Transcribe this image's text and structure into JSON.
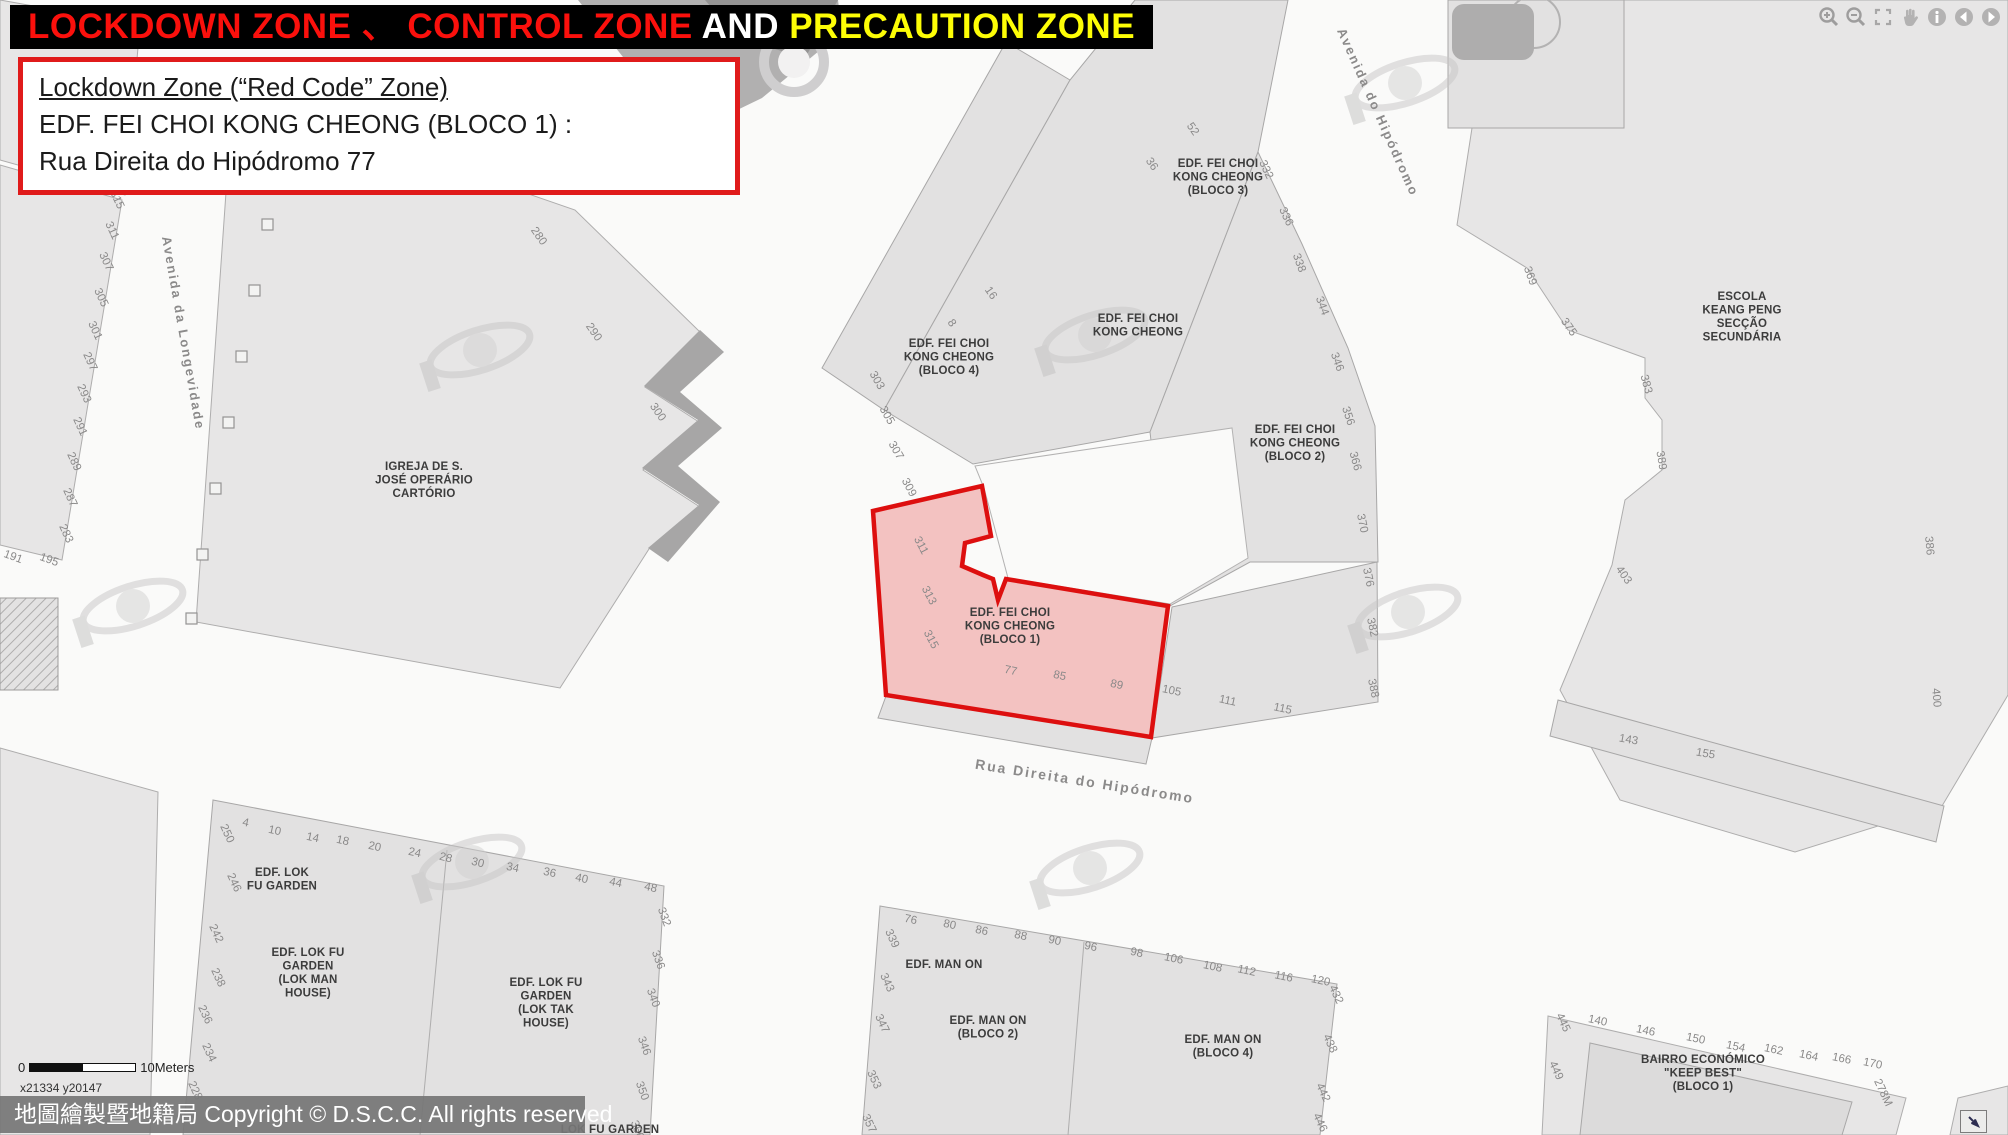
{
  "title": {
    "part1": "LOCKDOWN ZONE 、 CONTROL ZONE",
    "part2": " AND ",
    "part3": "PRECAUTION ZONE"
  },
  "info_box": {
    "line1": "Lockdown Zone (“Red Code” Zone)",
    "line2": "EDF. FEI CHOI KONG CHEONG (BLOCO 1) :",
    "line3": "Rua Direita do Hipódromo  77"
  },
  "toolbar": {
    "buttons": [
      "zoom-in",
      "zoom-out",
      "full-extent",
      "pan",
      "identify",
      "previous-extent",
      "next-extent"
    ]
  },
  "scale_bar": {
    "zero_label": "0",
    "distance_label": "10Meters",
    "coordinates": "x21334  y20147"
  },
  "copyright_bar": {
    "text": "地圖繪製暨地籍局 Copyright © D.S.C.C. All rights reserved"
  },
  "colors": {
    "title_red": "#fb100c",
    "title_white": "#ffffff",
    "title_yellow": "#fdfd06",
    "info_border": "#e01b1b",
    "lockdown_fill": "#f1b7b7",
    "lockdown_border": "#dd0f0f"
  },
  "map": {
    "street_labels": [
      {
        "text": "Avenida da Longevidade",
        "x": 179,
        "y": 334,
        "rot": 80,
        "size": 13
      },
      {
        "text": "Avenida do Hipódromo",
        "x": 1374,
        "y": 114,
        "rot": 66,
        "size": 13
      },
      {
        "text": "Rua Direita do Hipódromo",
        "x": 1084,
        "y": 786,
        "rot": 9,
        "size": 14
      }
    ],
    "building_labels": [
      {
        "lines": [
          "IGREJA DE S.",
          "JOSÉ OPERÁRIO",
          "CARTÓRIO"
        ],
        "x": 424,
        "y": 470
      },
      {
        "lines": [
          "EDF. FEI CHOI",
          "KONG CHEONG",
          "(BLOCO 4)"
        ],
        "x": 949,
        "y": 347
      },
      {
        "lines": [
          "EDF. FEI CHOI",
          "KONG CHEONG",
          "(BLOCO 3)"
        ],
        "x": 1218,
        "y": 167
      },
      {
        "lines": [
          "EDF. FEI CHOI",
          "KONG CHEONG"
        ],
        "x": 1138,
        "y": 322
      },
      {
        "lines": [
          "EDF. FEI CHOI",
          "KONG CHEONG",
          "(BLOCO 2)"
        ],
        "x": 1295,
        "y": 433
      },
      {
        "lines": [
          "EDF. FEI CHOI",
          "KONG CHEONG",
          "(BLOCO 1)"
        ],
        "x": 1010,
        "y": 616
      },
      {
        "lines": [
          "ESCOLA",
          "KEANG PENG",
          "SECÇÃO",
          "SECUNDÁRIA"
        ],
        "x": 1742,
        "y": 300
      },
      {
        "lines": [
          "EDF. LOK",
          "FU GARDEN"
        ],
        "x": 282,
        "y": 876
      },
      {
        "lines": [
          "EDF. LOK FU",
          "GARDEN",
          "(LOK MAN",
          "HOUSE)"
        ],
        "x": 308,
        "y": 956
      },
      {
        "lines": [
          "EDF. LOK FU",
          "GARDEN",
          "(LOK TAK",
          "HOUSE)"
        ],
        "x": 546,
        "y": 986
      },
      {
        "lines": [
          "EDF. MAN ON"
        ],
        "x": 944,
        "y": 968
      },
      {
        "lines": [
          "EDF. MAN ON",
          "(BLOCO 2)"
        ],
        "x": 988,
        "y": 1024
      },
      {
        "lines": [
          "EDF. MAN ON",
          "(BLOCO 4)"
        ],
        "x": 1223,
        "y": 1043
      },
      {
        "lines": [
          "BAIRRO ECONÓMICO",
          "\"KEEP BEST\"",
          "(BLOCO 1)"
        ],
        "x": 1703,
        "y": 1063
      },
      {
        "lines": [
          "LOK FU GARDEN"
        ],
        "x": 610,
        "y": 1133
      }
    ],
    "house_numbers": [
      {
        "t": "315",
        "x": 114,
        "y": 201,
        "r": 65
      },
      {
        "t": "311",
        "x": 109,
        "y": 232,
        "r": 65
      },
      {
        "t": "307",
        "x": 103,
        "y": 263,
        "r": 65
      },
      {
        "t": "305",
        "x": 98,
        "y": 299,
        "r": 65
      },
      {
        "t": "301",
        "x": 92,
        "y": 332,
        "r": 65
      },
      {
        "t": "297",
        "x": 87,
        "y": 363,
        "r": 65
      },
      {
        "t": "293",
        "x": 81,
        "y": 395,
        "r": 65
      },
      {
        "t": "291",
        "x": 77,
        "y": 428,
        "r": 65
      },
      {
        "t": "289",
        "x": 71,
        "y": 463,
        "r": 65
      },
      {
        "t": "287",
        "x": 67,
        "y": 499,
        "r": 65
      },
      {
        "t": "283",
        "x": 63,
        "y": 535,
        "r": 65
      },
      {
        "t": "191",
        "x": 12,
        "y": 560,
        "r": 20
      },
      {
        "t": "195",
        "x": 48,
        "y": 563,
        "r": 20
      },
      {
        "t": "280",
        "x": 536,
        "y": 238,
        "r": 55
      },
      {
        "t": "290",
        "x": 591,
        "y": 334,
        "r": 55
      },
      {
        "t": "300",
        "x": 655,
        "y": 414,
        "r": 55
      },
      {
        "t": "8",
        "x": 949,
        "y": 325,
        "r": 55
      },
      {
        "t": "16",
        "x": 988,
        "y": 295,
        "r": 55
      },
      {
        "t": "36",
        "x": 1149,
        "y": 166,
        "r": 55
      },
      {
        "t": "52",
        "x": 1190,
        "y": 131,
        "r": 55
      },
      {
        "t": "332",
        "x": 1263,
        "y": 171,
        "r": 65
      },
      {
        "t": "336",
        "x": 1283,
        "y": 218,
        "r": 65
      },
      {
        "t": "338",
        "x": 1296,
        "y": 264,
        "r": 70
      },
      {
        "t": "344",
        "x": 1319,
        "y": 307,
        "r": 70
      },
      {
        "t": "346",
        "x": 1334,
        "y": 363,
        "r": 70
      },
      {
        "t": "356",
        "x": 1345,
        "y": 417,
        "r": 72
      },
      {
        "t": "366",
        "x": 1352,
        "y": 462,
        "r": 75
      },
      {
        "t": "370",
        "x": 1359,
        "y": 524,
        "r": 78
      },
      {
        "t": "376",
        "x": 1365,
        "y": 578,
        "r": 78
      },
      {
        "t": "382",
        "x": 1369,
        "y": 628,
        "r": 78
      },
      {
        "t": "388",
        "x": 1370,
        "y": 689,
        "r": 78
      },
      {
        "t": "303",
        "x": 874,
        "y": 382,
        "r": 60
      },
      {
        "t": "305",
        "x": 884,
        "y": 417,
        "r": 60
      },
      {
        "t": "307",
        "x": 893,
        "y": 452,
        "r": 60
      },
      {
        "t": "309",
        "x": 906,
        "y": 489,
        "r": 62
      },
      {
        "t": "311",
        "x": 918,
        "y": 547,
        "r": 62
      },
      {
        "t": "313",
        "x": 926,
        "y": 597,
        "r": 62
      },
      {
        "t": "315",
        "x": 928,
        "y": 641,
        "r": 62
      },
      {
        "t": "77",
        "x": 1010,
        "y": 674,
        "r": 12
      },
      {
        "t": "85",
        "x": 1059,
        "y": 679,
        "r": 12
      },
      {
        "t": "89",
        "x": 1116,
        "y": 688,
        "r": 12
      },
      {
        "t": "105",
        "x": 1171,
        "y": 694,
        "r": 12
      },
      {
        "t": "111",
        "x": 1227,
        "y": 704,
        "r": 12
      },
      {
        "t": "115",
        "x": 1282,
        "y": 712,
        "r": 12
      },
      {
        "t": "369",
        "x": 1527,
        "y": 277,
        "r": 70
      },
      {
        "t": "375",
        "x": 1566,
        "y": 329,
        "r": 55
      },
      {
        "t": "383",
        "x": 1643,
        "y": 385,
        "r": 75
      },
      {
        "t": "389",
        "x": 1658,
        "y": 461,
        "r": 80
      },
      {
        "t": "403",
        "x": 1621,
        "y": 577,
        "r": 55
      },
      {
        "t": "386",
        "x": 1926,
        "y": 546,
        "r": 85
      },
      {
        "t": "400",
        "x": 1933,
        "y": 698,
        "r": 85
      },
      {
        "t": "143",
        "x": 1628,
        "y": 743,
        "r": 10
      },
      {
        "t": "155",
        "x": 1705,
        "y": 757,
        "r": 10
      },
      {
        "t": "4",
        "x": 245,
        "y": 826,
        "r": 12
      },
      {
        "t": "10",
        "x": 274,
        "y": 834,
        "r": 12
      },
      {
        "t": "14",
        "x": 312,
        "y": 841,
        "r": 12
      },
      {
        "t": "18",
        "x": 342,
        "y": 844,
        "r": 12
      },
      {
        "t": "20",
        "x": 374,
        "y": 850,
        "r": 12
      },
      {
        "t": "24",
        "x": 414,
        "y": 856,
        "r": 12
      },
      {
        "t": "28",
        "x": 445,
        "y": 861,
        "r": 14
      },
      {
        "t": "30",
        "x": 477,
        "y": 866,
        "r": 14
      },
      {
        "t": "34",
        "x": 512,
        "y": 871,
        "r": 12
      },
      {
        "t": "36",
        "x": 549,
        "y": 876,
        "r": 12
      },
      {
        "t": "40",
        "x": 581,
        "y": 882,
        "r": 12
      },
      {
        "t": "44",
        "x": 615,
        "y": 886,
        "r": 12
      },
      {
        "t": "48",
        "x": 650,
        "y": 891,
        "r": 12
      },
      {
        "t": "250",
        "x": 224,
        "y": 835,
        "r": 65
      },
      {
        "t": "246",
        "x": 231,
        "y": 884,
        "r": 65
      },
      {
        "t": "242",
        "x": 213,
        "y": 935,
        "r": 65
      },
      {
        "t": "238",
        "x": 215,
        "y": 979,
        "r": 65
      },
      {
        "t": "236",
        "x": 202,
        "y": 1016,
        "r": 65
      },
      {
        "t": "234",
        "x": 206,
        "y": 1054,
        "r": 65
      },
      {
        "t": "228",
        "x": 192,
        "y": 1092,
        "r": 65
      },
      {
        "t": "332",
        "x": 661,
        "y": 918,
        "r": 70
      },
      {
        "t": "336",
        "x": 655,
        "y": 961,
        "r": 70
      },
      {
        "t": "340",
        "x": 650,
        "y": 999,
        "r": 70
      },
      {
        "t": "346",
        "x": 641,
        "y": 1047,
        "r": 70
      },
      {
        "t": "350",
        "x": 639,
        "y": 1092,
        "r": 70
      },
      {
        "t": "356",
        "x": 634,
        "y": 1131,
        "r": 70
      },
      {
        "t": "76",
        "x": 910,
        "y": 923,
        "r": 12
      },
      {
        "t": "80",
        "x": 949,
        "y": 928,
        "r": 12
      },
      {
        "t": "86",
        "x": 981,
        "y": 934,
        "r": 12
      },
      {
        "t": "88",
        "x": 1020,
        "y": 939,
        "r": 12
      },
      {
        "t": "90",
        "x": 1054,
        "y": 944,
        "r": 12
      },
      {
        "t": "96",
        "x": 1090,
        "y": 950,
        "r": 12
      },
      {
        "t": "98",
        "x": 1136,
        "y": 956,
        "r": 12
      },
      {
        "t": "106",
        "x": 1173,
        "y": 962,
        "r": 12
      },
      {
        "t": "108",
        "x": 1212,
        "y": 970,
        "r": 12
      },
      {
        "t": "112",
        "x": 1246,
        "y": 974,
        "r": 12
      },
      {
        "t": "116",
        "x": 1283,
        "y": 980,
        "r": 12
      },
      {
        "t": "120",
        "x": 1320,
        "y": 984,
        "r": 12
      },
      {
        "t": "339",
        "x": 889,
        "y": 940,
        "r": 65
      },
      {
        "t": "343",
        "x": 884,
        "y": 984,
        "r": 65
      },
      {
        "t": "347",
        "x": 879,
        "y": 1025,
        "r": 65
      },
      {
        "t": "353",
        "x": 871,
        "y": 1081,
        "r": 65
      },
      {
        "t": "357",
        "x": 866,
        "y": 1125,
        "r": 65
      },
      {
        "t": "432",
        "x": 1333,
        "y": 996,
        "r": 65
      },
      {
        "t": "438",
        "x": 1327,
        "y": 1045,
        "r": 65
      },
      {
        "t": "442",
        "x": 1320,
        "y": 1094,
        "r": 65
      },
      {
        "t": "446",
        "x": 1317,
        "y": 1124,
        "r": 65
      },
      {
        "t": "445",
        "x": 1560,
        "y": 1024,
        "r": 65
      },
      {
        "t": "449",
        "x": 1553,
        "y": 1072,
        "r": 65
      },
      {
        "t": "140",
        "x": 1597,
        "y": 1024,
        "r": 12
      },
      {
        "t": "146",
        "x": 1645,
        "y": 1034,
        "r": 12
      },
      {
        "t": "150",
        "x": 1695,
        "y": 1042,
        "r": 12
      },
      {
        "t": "154",
        "x": 1735,
        "y": 1050,
        "r": 12
      },
      {
        "t": "162",
        "x": 1773,
        "y": 1053,
        "r": 12
      },
      {
        "t": "164",
        "x": 1808,
        "y": 1059,
        "r": 12
      },
      {
        "t": "166",
        "x": 1841,
        "y": 1062,
        "r": 12
      },
      {
        "t": "170",
        "x": 1872,
        "y": 1067,
        "r": 12
      },
      {
        "t": "278M",
        "x": 1880,
        "y": 1094,
        "r": 65
      }
    ]
  }
}
